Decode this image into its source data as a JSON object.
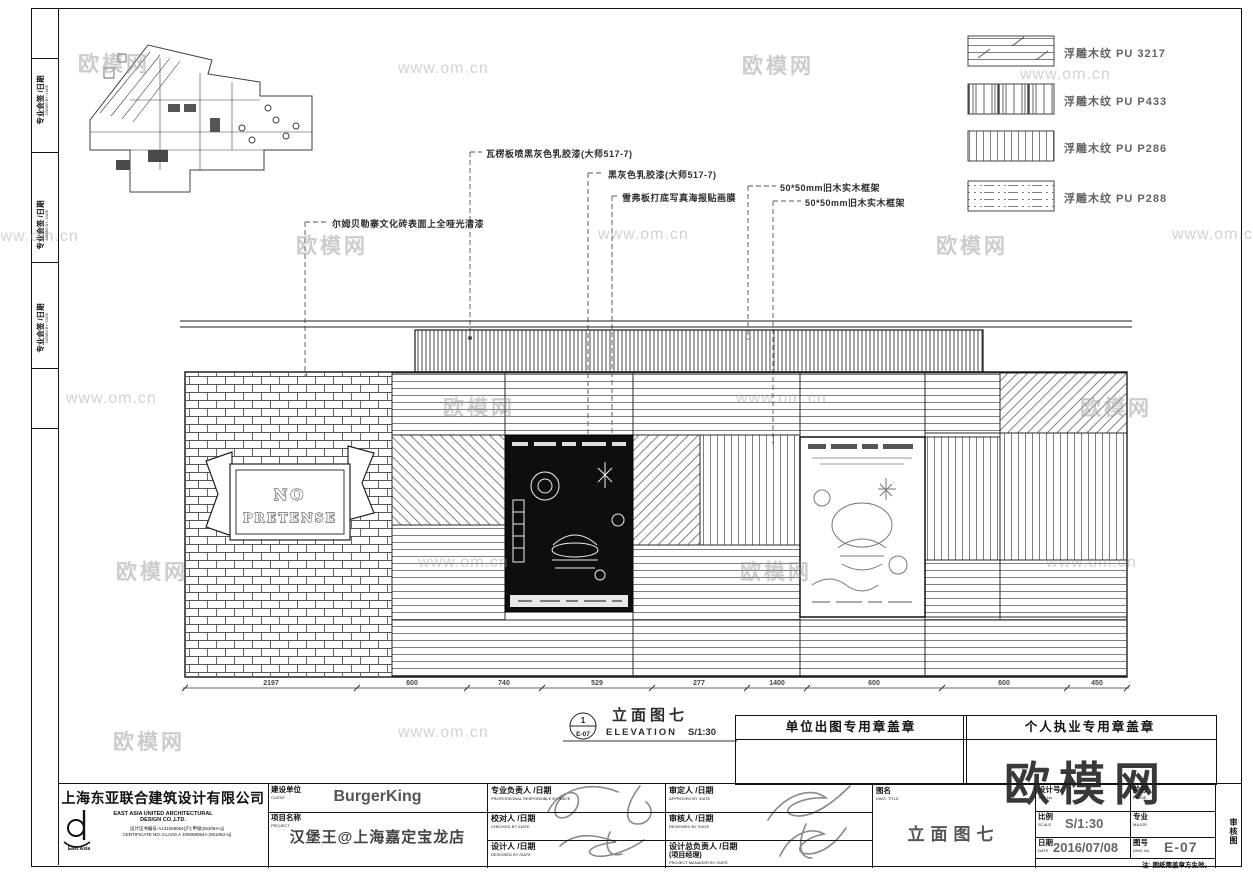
{
  "watermark": {
    "brand": "欧模网",
    "url": "www.om.cn"
  },
  "side_strip": {
    "label_cn": "专业会签 /日期",
    "label_en": "SIGNED BY / DATE"
  },
  "legend": {
    "items": [
      {
        "label": "浮雕木纹 PU 3217"
      },
      {
        "label": "浮雕木纹 PU P433"
      },
      {
        "label": "浮雕木纹 PU P286"
      },
      {
        "label": "浮雕木纹 PU P288"
      }
    ]
  },
  "annotations": {
    "corrugated": "瓦楞板喷黑灰色乳胶漆(大师517-7)",
    "paint": "黑灰色乳胶漆(大师517-7)",
    "poster": "雪弗板打底写真海报贴画膜",
    "frame1": "50*50mm旧木实木框架",
    "frame2": "50*50mm旧木实木框架",
    "brick": "尔姆贝勒寨文化砖表面上全哑光清漆"
  },
  "elevation": {
    "banner_line1": "NO",
    "banner_line2": "PRETENSE",
    "ref_top": "1",
    "ref_bottom": "E-07",
    "title": "立面图七",
    "title_en": "ELEVATION",
    "scale": "S/1:30",
    "dimensions": [
      "2197",
      "600",
      "740",
      "529",
      "277",
      "1400",
      "600",
      "600",
      "450"
    ]
  },
  "stamps": {
    "unit": "单位出图专用章盖章",
    "personal": "个人执业专用章盖章"
  },
  "titleblock": {
    "company_cn": "上海东亚联合建筑设计有限公司",
    "company_en1": "EAST ASIA UNITED ARCHITECTURAL",
    "company_en2": "DESIGN  CO.,LTD.",
    "cert_cn": "设计证书编号:A131069064(沪);甲级(061064-sj)",
    "cert_en": "CERTIFICATE NO.:CLASS A 100069064A (061064-sj)",
    "logo_text": "East  Asia",
    "client_label": "建设单位",
    "client_label_en": "CLIENT",
    "client": "BurgerKing",
    "project_label": "项目名称",
    "project_label_en": "PROJECT",
    "project": "汉堡王@上海嘉定宝龙店",
    "roles": [
      {
        "cn": "专业负责人 /日期",
        "en": "PROFESSIONAL RESPONSIBLE BY /DATE"
      },
      {
        "cn": "校对人 /日期",
        "en": "CHECKED BY /DATE"
      },
      {
        "cn": "设计人 /日期",
        "en": "DESIGNED BY /DATE"
      },
      {
        "cn": "审定人 /日期",
        "en": "APPROVED BY /DATE"
      },
      {
        "cn": "审核人 /日期",
        "en": "REVIEWED BY /DATE"
      },
      {
        "cn": "设计总负责人 /日期",
        "cn2": "(项目经理)",
        "en": "PROJECT MANAGER BY /DATE"
      }
    ],
    "dwg_title_label": "图名",
    "dwg_title_label_en": "DWG. TITLE",
    "dwg_title": "立面图七",
    "fields": [
      {
        "label": "设计号",
        "label_en": "JOB No.",
        "value": ""
      },
      {
        "label": "阶段",
        "label_en": "PHASE",
        "value": ""
      },
      {
        "label": "比例",
        "label_en": "SCALE",
        "value": "S/1:30"
      },
      {
        "label": "专业",
        "label_en": "MAJOR",
        "value": ""
      },
      {
        "label": "日期",
        "label_en": "DATE",
        "value": "2016/07/08"
      },
      {
        "label": "图号",
        "label_en": "DWG No.",
        "value": "E-07"
      }
    ],
    "note": "注: 图纸需盖章方生效。",
    "side_label": "审核图"
  }
}
